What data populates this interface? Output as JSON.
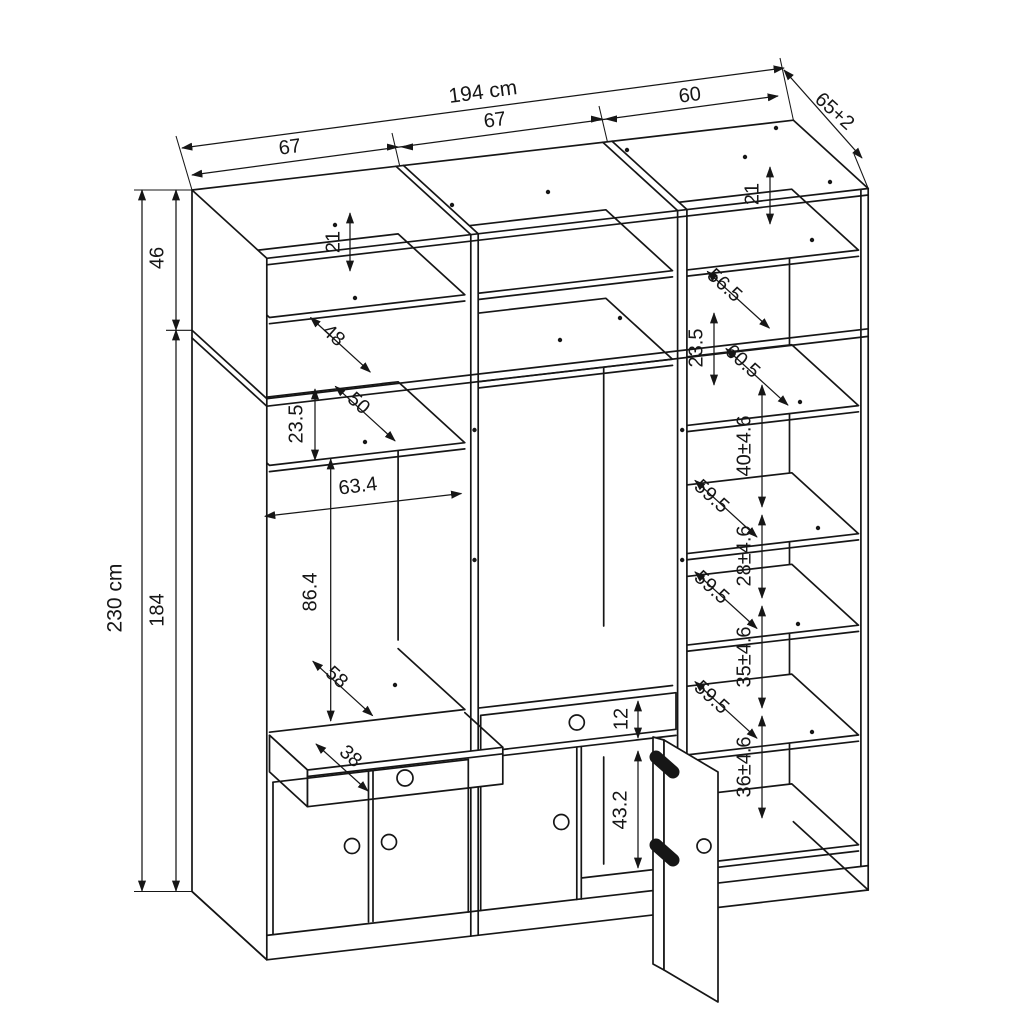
{
  "diagram": {
    "subject": "Three-section wardrobe dimensional line drawing (isometric view)",
    "units": "cm",
    "overall": {
      "width": "194 cm",
      "left_section_width": "67",
      "middle_section_width": "67",
      "right_section_width": "60",
      "depth": "65+2",
      "height": "230 cm",
      "upper_cabinet_height": "46",
      "lower_cabinet_height": "184"
    },
    "left_section": {
      "top_shelf_gap": "21",
      "top_shelf_depth": "48",
      "shelf_gap": "23.5",
      "shelf_depth": "50",
      "opening_width": "63.4",
      "opening_height": "86.4",
      "bottom_panel_depth": "58",
      "drawer_depth": "38"
    },
    "middle_section": {
      "drawer_front_height": "12",
      "door_opening_height": "43.2"
    },
    "right_section": {
      "top_shelf_gap": "21",
      "top_panel_depth": "56.5",
      "shelf_gap": "23.5",
      "upper_shelf_depth": "60.5",
      "shelf_depths": [
        "59.5",
        "59.5",
        "59.5"
      ],
      "compartment_heights": [
        "40±4.6",
        "28±4.6",
        "35±4.6",
        "36±4.6"
      ]
    }
  }
}
